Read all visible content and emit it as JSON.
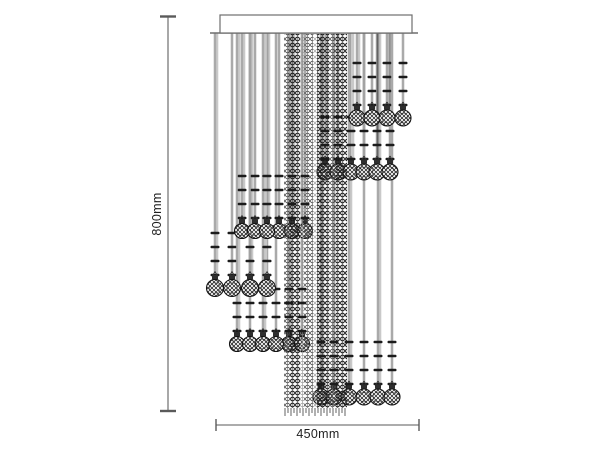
{
  "diagram": {
    "type": "chandelier-dimension-drawing",
    "height_label": "800mm",
    "width_label": "450mm"
  },
  "drawing": {
    "canvas": {
      "w": 600,
      "h": 450,
      "bg": "#ffffff"
    },
    "colors": {
      "dim_line": "#7a7a7a",
      "dim_cap": "#5a5a5a",
      "canopy_stroke": "#6e6e6e",
      "strand_dark": "#636363",
      "strand_light": "#c9c9c9",
      "tick": "#1b1b1b",
      "ball_stroke": "#141414",
      "cap_fill": "#2e2e2e",
      "fringe": "#3c3c3c",
      "bead_dark": "#161616",
      "bead_mid": "#3f3f3f",
      "bead_light": "#8f8f8f",
      "facet": "#111111"
    },
    "dim_v": {
      "x": 168,
      "y1": 16.5,
      "y2": 411,
      "cap_x1": 160,
      "cap_x2": 176
    },
    "dim_h": {
      "y": 425,
      "x1": 216,
      "x2": 419,
      "tick_y1": 419,
      "tick_y2": 431
    },
    "canopy": {
      "x": 220,
      "y": 15,
      "w": 192,
      "h": 18,
      "base_x1": 210,
      "base_x2": 418
    },
    "column": {
      "x1": 284,
      "x2": 347,
      "y1": 34,
      "y2": 408,
      "strips": [
        {
          "x": 284,
          "w": 6,
          "tone": "mid"
        },
        {
          "x": 290,
          "w": 10,
          "tone": "dark"
        },
        {
          "x": 300,
          "w": 4,
          "tone": "light"
        },
        {
          "x": 304,
          "w": 9,
          "tone": "mid"
        },
        {
          "x": 313,
          "w": 4,
          "tone": "light"
        },
        {
          "x": 317,
          "w": 12,
          "tone": "dark"
        },
        {
          "x": 329,
          "w": 7,
          "tone": "mid"
        },
        {
          "x": 336,
          "w": 11,
          "tone": "dark"
        }
      ]
    },
    "strand_top": 33,
    "tick_offsets": [
      -55,
      -41,
      -27,
      -13
    ],
    "tick_w": 9,
    "tick_h": 2.4,
    "clusters": [
      {
        "ball_y": 118,
        "r": 8,
        "xs": [
          357,
          372,
          387,
          403
        ]
      },
      {
        "ball_y": 172,
        "r": 8,
        "xs": [
          325,
          338,
          351,
          364,
          377,
          390
        ]
      },
      {
        "ball_y": 231,
        "r": 7.5,
        "xs": [
          242,
          255,
          267,
          279,
          292,
          305
        ]
      },
      {
        "ball_y": 288,
        "r": 8.5,
        "xs": [
          215,
          232,
          250,
          267
        ]
      },
      {
        "ball_y": 344,
        "r": 7.5,
        "xs": [
          237,
          250,
          263,
          276,
          289,
          302
        ]
      },
      {
        "ball_y": 397,
        "r": 8,
        "xs": [
          321,
          334,
          349,
          364,
          378,
          392
        ]
      }
    ]
  }
}
